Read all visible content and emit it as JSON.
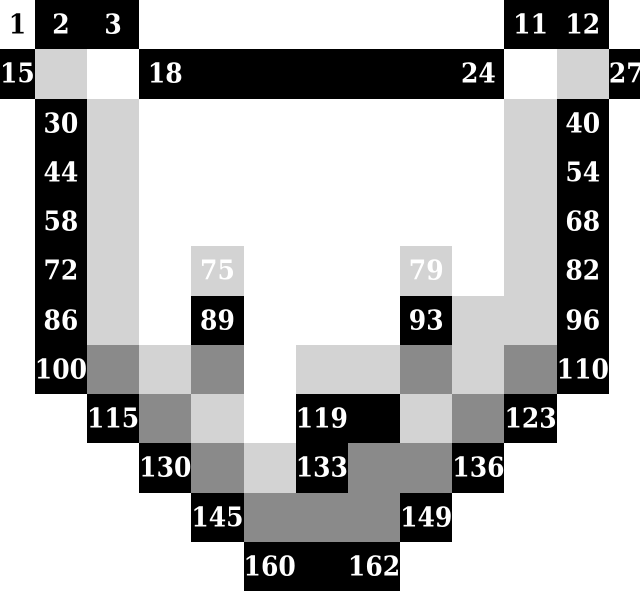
{
  "puzzle": {
    "title": "numbered-pixel-grid-puzzle",
    "columns": 13,
    "rows": 12,
    "palette": {
      "W": "#ffffff",
      "K": "#000000",
      "L": "#d3d3d3",
      "M": "#8a8a8a"
    },
    "number_color_on_white": "#000000",
    "number_color_on_dark": "#ffffff",
    "color_map": [
      "WKKWWWWWWWKKW",
      "KLWKKKKKKKWLK",
      "WKLWWWWWWWLKW",
      "WKLWWWWWWWLKW",
      "WKLWWWWWWWLKW",
      "WKLWLWWWLWLKW",
      "WKLWKWWWKLLKW",
      "WKMLMWLLMLMKW",
      "WWKMLWKKLMKWW",
      "WWWKMLKMMKWWW",
      "WWWWKMMMKWWWW",
      "WWWWWKKKWWWWW"
    ],
    "numbers": [
      {
        "row": 0,
        "col": 0,
        "value": "1"
      },
      {
        "row": 0,
        "col": 1,
        "value": "2"
      },
      {
        "row": 0,
        "col": 2,
        "value": "3"
      },
      {
        "row": 0,
        "col": 10,
        "value": "11"
      },
      {
        "row": 0,
        "col": 11,
        "value": "12"
      },
      {
        "row": 1,
        "col": 0,
        "value": "15"
      },
      {
        "row": 1,
        "col": 3,
        "value": "18"
      },
      {
        "row": 1,
        "col": 9,
        "value": "24"
      },
      {
        "row": 1,
        "col": 12,
        "value": "27"
      },
      {
        "row": 2,
        "col": 1,
        "value": "30"
      },
      {
        "row": 2,
        "col": 11,
        "value": "40"
      },
      {
        "row": 3,
        "col": 1,
        "value": "44"
      },
      {
        "row": 3,
        "col": 11,
        "value": "54"
      },
      {
        "row": 4,
        "col": 1,
        "value": "58"
      },
      {
        "row": 4,
        "col": 11,
        "value": "68"
      },
      {
        "row": 5,
        "col": 1,
        "value": "72"
      },
      {
        "row": 5,
        "col": 4,
        "value": "75"
      },
      {
        "row": 5,
        "col": 8,
        "value": "79"
      },
      {
        "row": 5,
        "col": 11,
        "value": "82"
      },
      {
        "row": 6,
        "col": 1,
        "value": "86"
      },
      {
        "row": 6,
        "col": 4,
        "value": "89"
      },
      {
        "row": 6,
        "col": 8,
        "value": "93"
      },
      {
        "row": 6,
        "col": 11,
        "value": "96"
      },
      {
        "row": 7,
        "col": 1,
        "value": "100"
      },
      {
        "row": 7,
        "col": 11,
        "value": "110"
      },
      {
        "row": 8,
        "col": 2,
        "value": "115"
      },
      {
        "row": 8,
        "col": 6,
        "value": "119"
      },
      {
        "row": 8,
        "col": 10,
        "value": "123"
      },
      {
        "row": 9,
        "col": 3,
        "value": "130"
      },
      {
        "row": 9,
        "col": 6,
        "value": "133"
      },
      {
        "row": 9,
        "col": 9,
        "value": "136"
      },
      {
        "row": 10,
        "col": 4,
        "value": "145"
      },
      {
        "row": 10,
        "col": 8,
        "value": "149"
      },
      {
        "row": 11,
        "col": 5,
        "value": "160"
      },
      {
        "row": 11,
        "col": 7,
        "value": "162"
      }
    ]
  }
}
